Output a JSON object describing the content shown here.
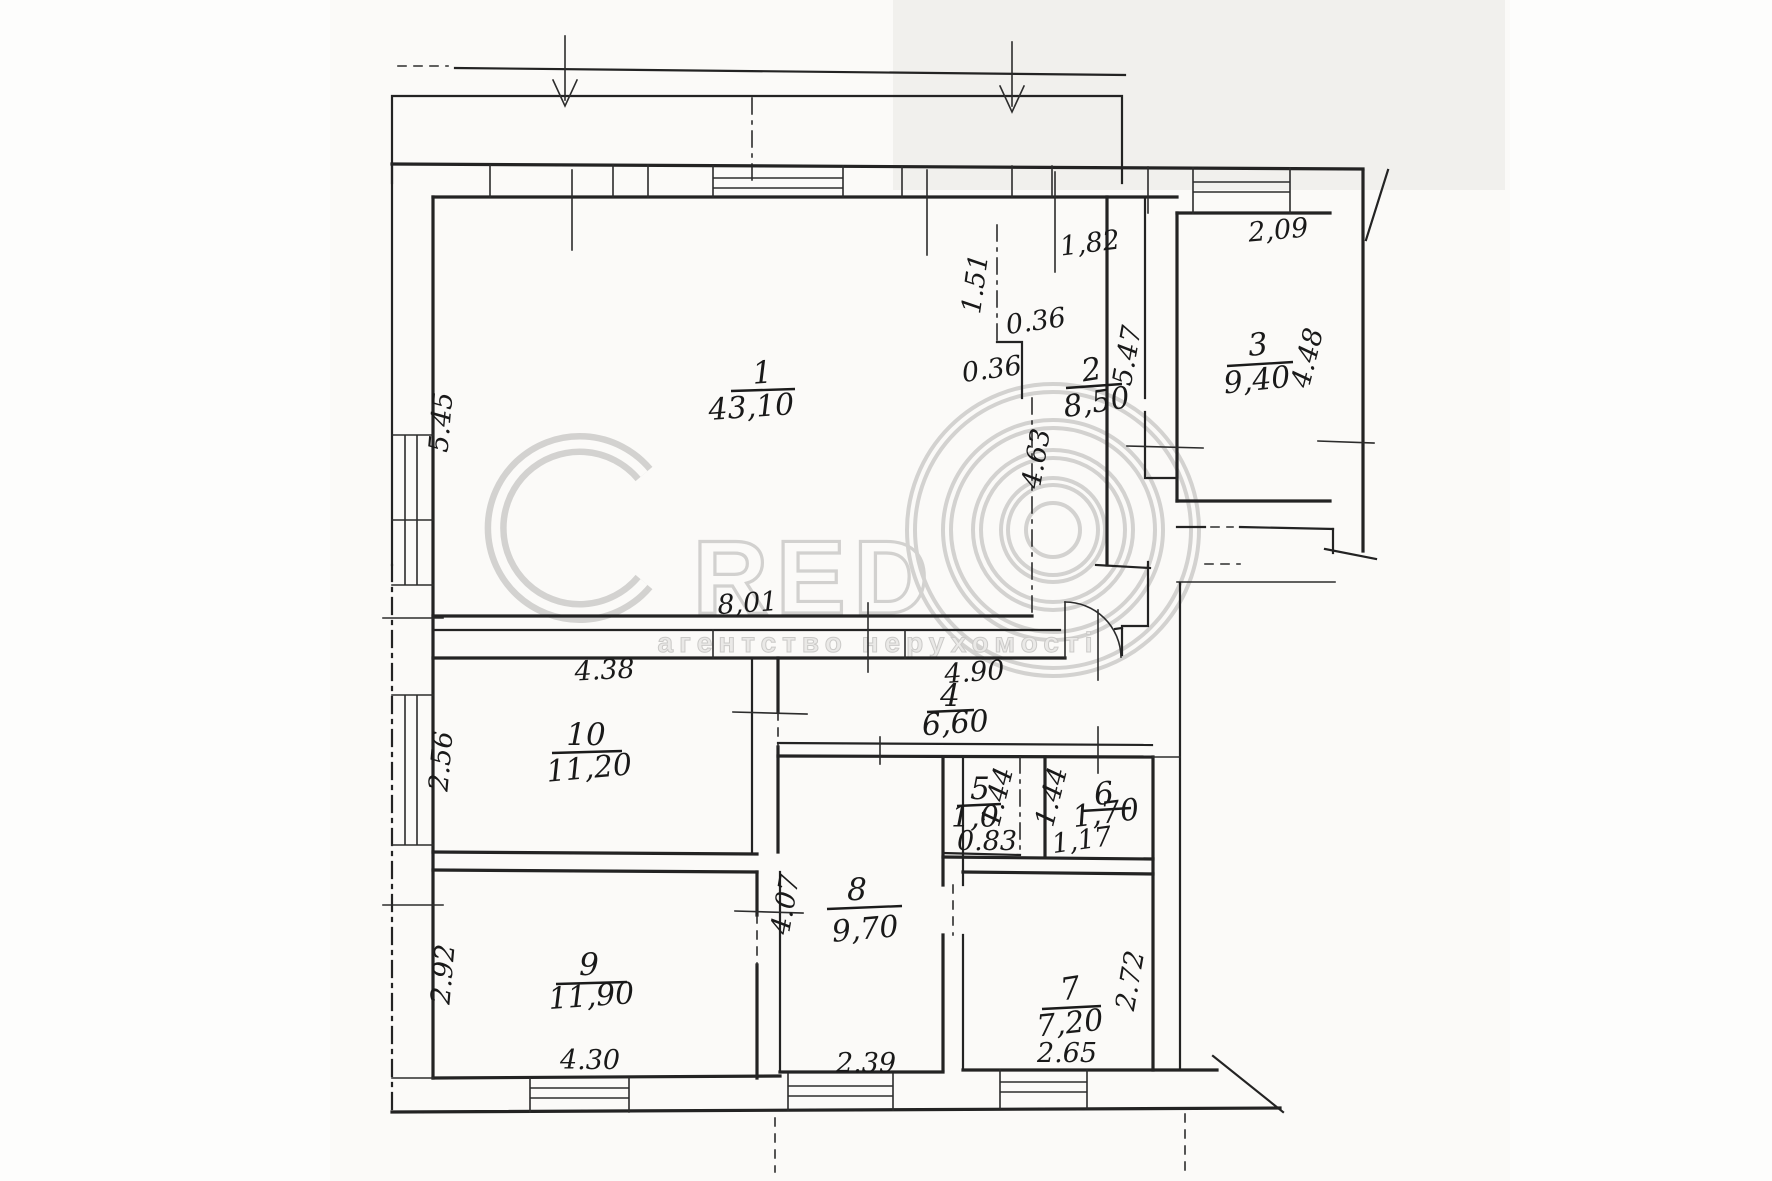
{
  "watermark": {
    "brand": "RED",
    "subtitle": "агентство нерухомості"
  },
  "icons": {
    "copyright": "concentric-rings-copyright",
    "entrance": "down-arrow"
  },
  "rooms": [
    {
      "number": "1",
      "area": "43,10"
    },
    {
      "number": "2",
      "area": "8,50"
    },
    {
      "number": "3",
      "area": "9,40"
    },
    {
      "number": "4",
      "area": "6,60"
    },
    {
      "number": "5",
      "area": "1,0"
    },
    {
      "number": "6",
      "area": "1,70"
    },
    {
      "number": "7",
      "area": "7,20"
    },
    {
      "number": "8",
      "area": "9,70"
    },
    {
      "number": "9",
      "area": "11,90"
    },
    {
      "number": "10",
      "area": "11,20"
    }
  ],
  "dims": {
    "d182": "1,82",
    "d209": "2,09",
    "v151": "1.51",
    "s036a": "0.36",
    "s036b": "0.36",
    "v545": "5.45",
    "v547": "5.47",
    "v448": "4.48",
    "v463": "4.63",
    "h801": "8,01",
    "h438": "4.38",
    "h490": "4.90",
    "v256": "2.56",
    "v144a": "1.44",
    "v144b": "1.44",
    "h083": "0.83",
    "h117": "1,17",
    "v407": "4.07",
    "v292": "2.92",
    "v272": "2.72",
    "h430": "4.30",
    "h239": "2.39",
    "h265": "2.65"
  }
}
